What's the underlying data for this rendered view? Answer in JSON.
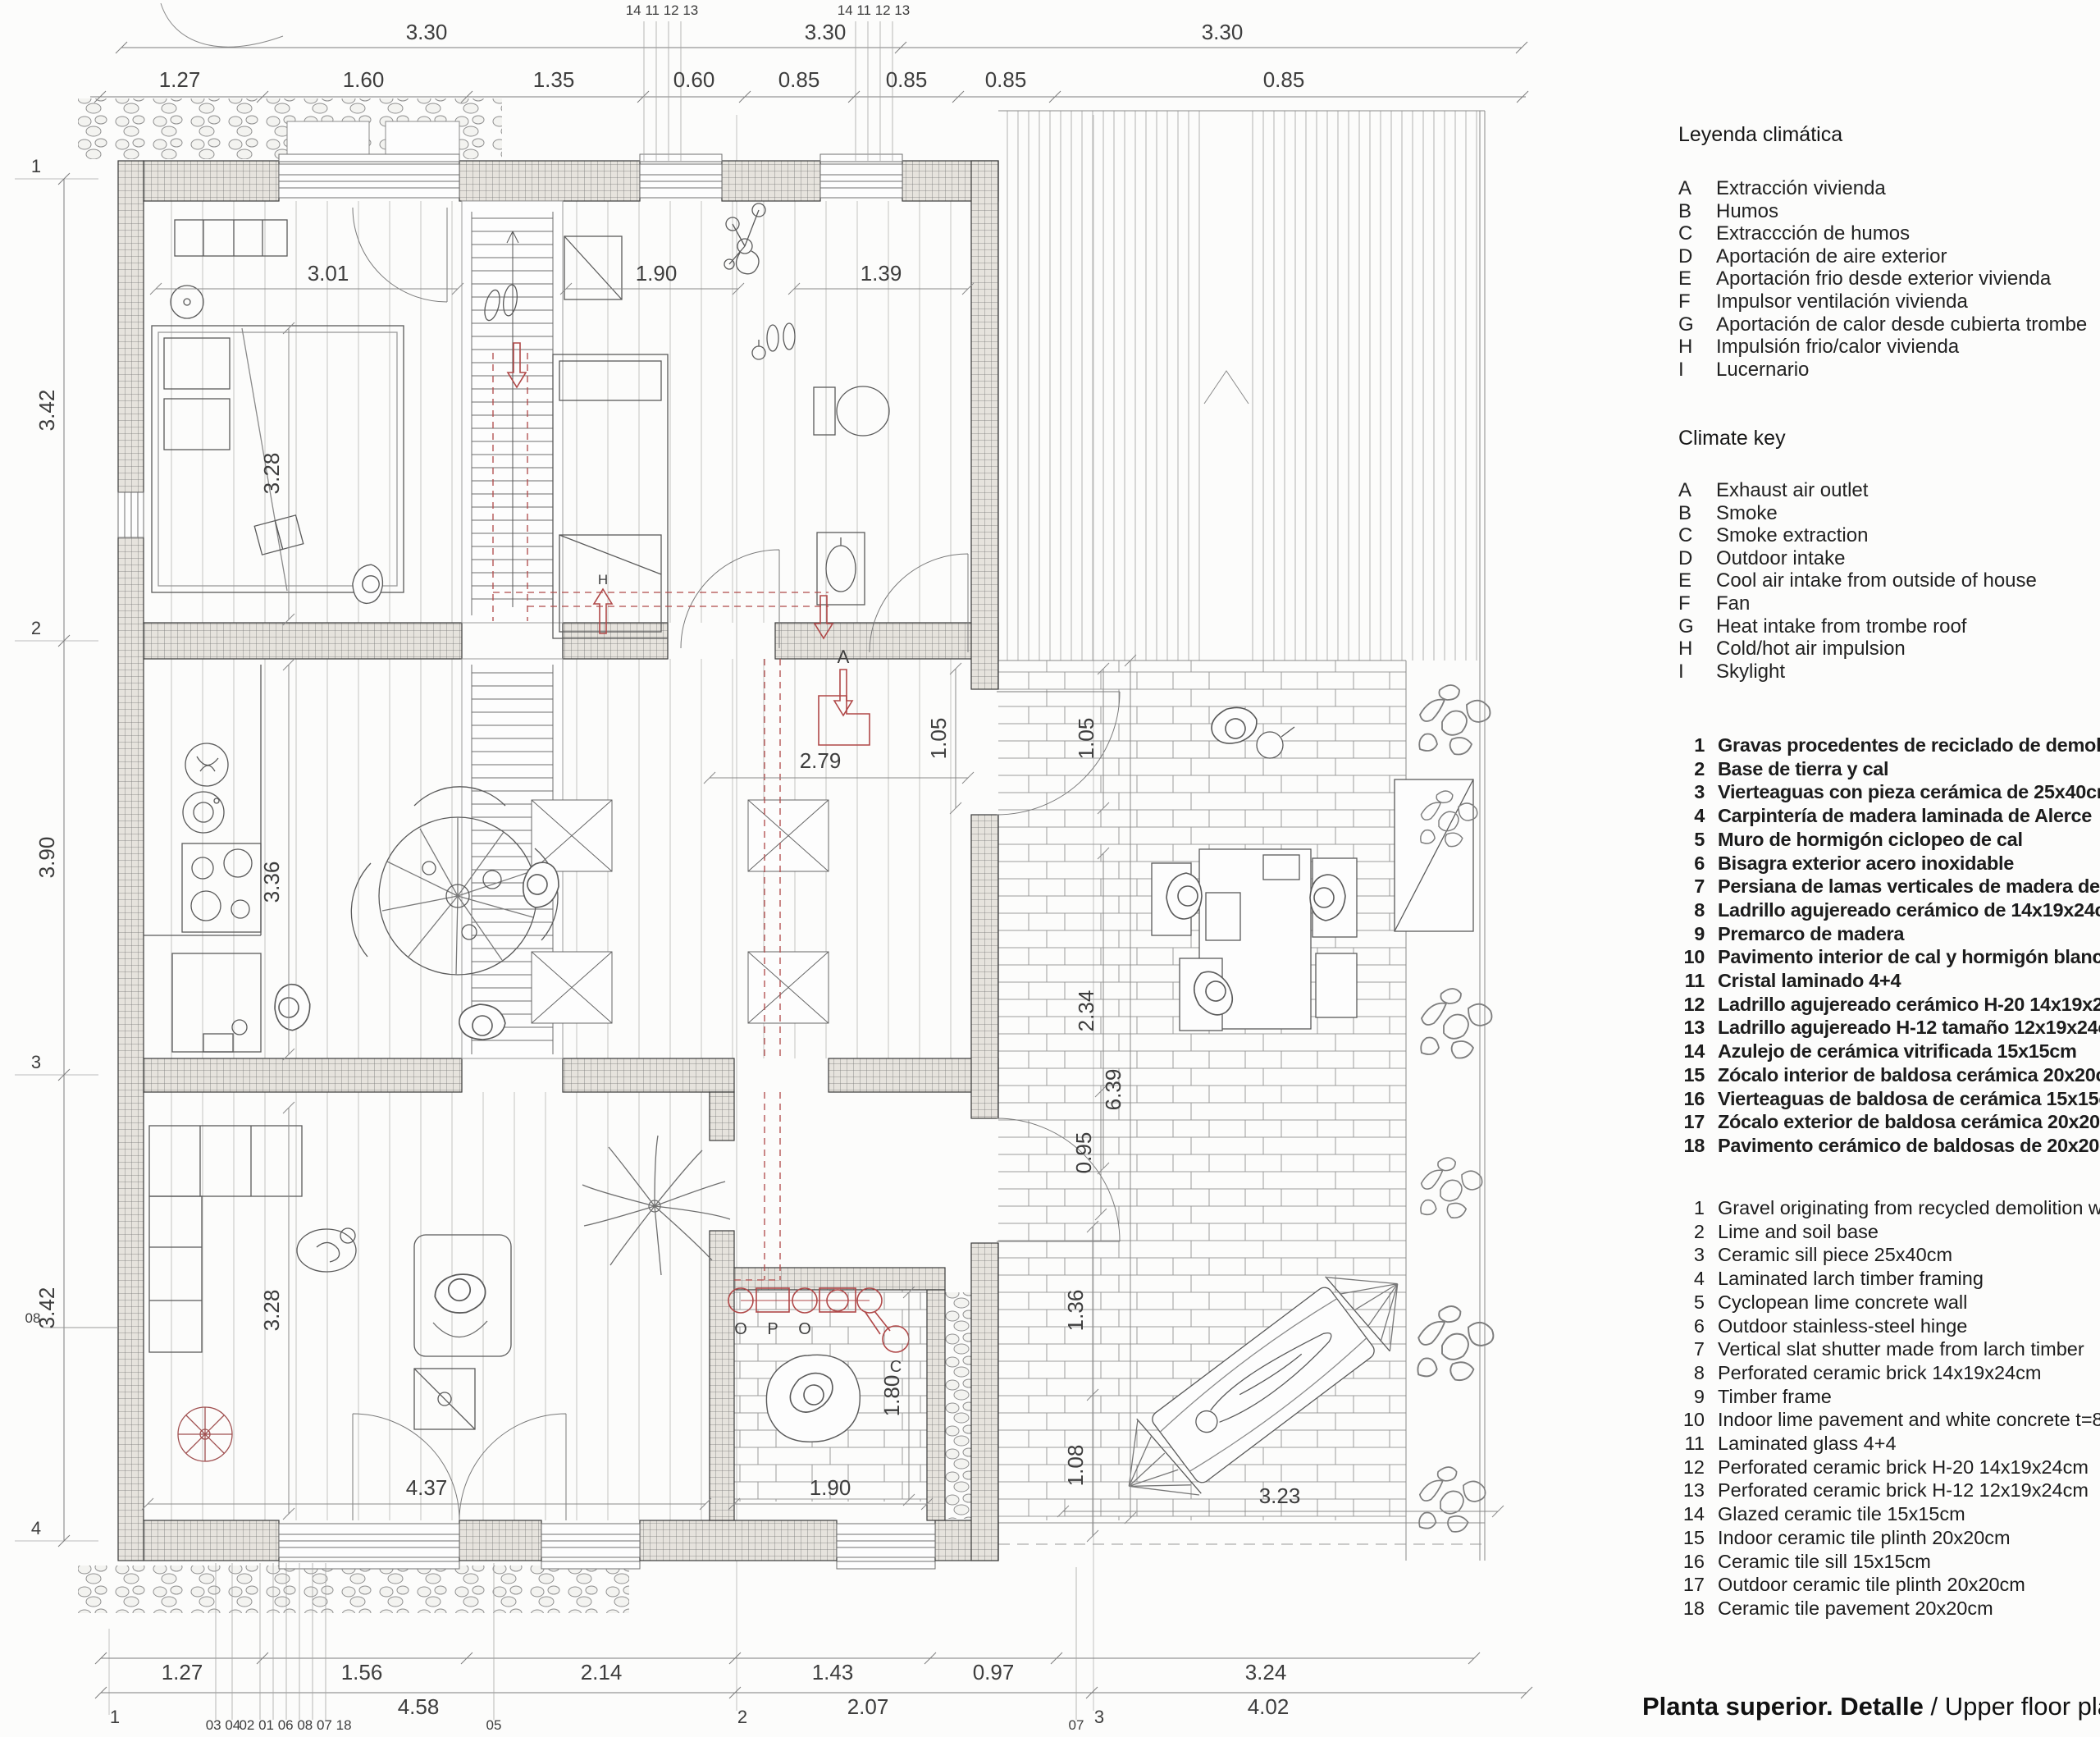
{
  "title": {
    "es": "Planta superior. Detalle",
    "sep": " / ",
    "en": "Upper floor plan. Det"
  },
  "legend_es": {
    "title": "Leyenda climática",
    "items": [
      [
        "A",
        "Extracción vivienda"
      ],
      [
        "B",
        "Humos"
      ],
      [
        "C",
        "Extraccción de humos"
      ],
      [
        "D",
        "Aportación de aire exterior"
      ],
      [
        "E",
        "Aportación frio desde exterior vivienda"
      ],
      [
        "F",
        "Impulsor ventilación vivienda"
      ],
      [
        "G",
        "Aportación de calor desde cubierta trombe"
      ],
      [
        "H",
        "Impulsión frio/calor vivienda"
      ],
      [
        "I",
        "Lucernario"
      ]
    ]
  },
  "legend_en": {
    "title": "Climate key",
    "items": [
      [
        "A",
        "Exhaust air outlet"
      ],
      [
        "B",
        "Smoke"
      ],
      [
        "C",
        "Smoke extraction"
      ],
      [
        "D",
        "Outdoor intake"
      ],
      [
        "E",
        "Cool air intake from outside of house"
      ],
      [
        "F",
        "Fan"
      ],
      [
        "G",
        "Heat intake from trombe roof"
      ],
      [
        "H",
        "Cold/hot air impulsion"
      ],
      [
        "I",
        "Skylight"
      ]
    ]
  },
  "notes_es": {
    "items": [
      [
        "1",
        "Gravas procedentes de reciclado de demolición"
      ],
      [
        "2",
        "Base de tierra y cal"
      ],
      [
        "3",
        "Vierteaguas con pieza cerámica de 25x40cm"
      ],
      [
        "4",
        "Carpintería de madera laminada de Alerce"
      ],
      [
        "5",
        "Muro de hormigón ciclopeo de cal"
      ],
      [
        "6",
        "Bisagra exterior acero inoxidable"
      ],
      [
        "7",
        "Persiana de lamas verticales de madera de alerce"
      ],
      [
        "8",
        "Ladrillo agujereado cerámico de 14x19x24cm"
      ],
      [
        "9",
        "Premarco de madera"
      ],
      [
        "10",
        "Pavimento interior de cal y hormigón blanco e:80m"
      ],
      [
        "11",
        "Cristal laminado 4+4"
      ],
      [
        "12",
        "Ladrillo agujereado cerámico H-20 14x19x24cm"
      ],
      [
        "13",
        "Ladrillo agujereado H-12 tamaño 12x19x24cm"
      ],
      [
        "14",
        "Azulejo de cerámica vitrificada 15x15cm"
      ],
      [
        "15",
        "Zócalo interior de baldosa cerámica 20x20cm"
      ],
      [
        "16",
        "Vierteaguas de baldosa de cerámica 15x15cm"
      ],
      [
        "17",
        "Zócalo exterior de baldosa cerámica 20x20cm"
      ],
      [
        "18",
        "Pavimento cerámico de baldosas de 20x20cm"
      ]
    ]
  },
  "notes_en": {
    "items": [
      [
        "1",
        "Gravel originating from recycled demolition waste"
      ],
      [
        "2",
        "Lime and soil base"
      ],
      [
        "3",
        "Ceramic sill piece 25x40cm"
      ],
      [
        "4",
        "Laminated larch timber framing"
      ],
      [
        "5",
        "Cyclopean lime concrete wall"
      ],
      [
        "6",
        "Outdoor stainless-steel hinge"
      ],
      [
        "7",
        "Vertical slat shutter made from larch timber"
      ],
      [
        "8",
        "Perforated ceramic brick 14x19x24cm"
      ],
      [
        "9",
        "Timber frame"
      ],
      [
        "10",
        "Indoor lime pavement and white concrete t=80mm"
      ],
      [
        "11",
        "Laminated glass 4+4"
      ],
      [
        "12",
        "Perforated ceramic brick H-20 14x19x24cm"
      ],
      [
        "13",
        "Perforated ceramic brick H-12 12x19x24cm"
      ],
      [
        "14",
        "Glazed ceramic tile 15x15cm"
      ],
      [
        "15",
        "Indoor ceramic tile plinth 20x20cm"
      ],
      [
        "16",
        "Ceramic tile sill 15x15cm"
      ],
      [
        "17",
        "Outdoor ceramic tile plinth 20x20cm"
      ],
      [
        "18",
        "Ceramic tile pavement 20x20cm"
      ]
    ]
  },
  "dims": {
    "top_overall": [
      "3.30",
      "3.30",
      "3.30"
    ],
    "top_detail": [
      "1.27",
      "1.60",
      "1.35",
      "0.60",
      "0.85",
      "0.85",
      "0.85",
      "0.85"
    ],
    "left": [
      "3.42",
      "3.90",
      "3.42"
    ],
    "bottom_detail": [
      "1.27",
      "1.56",
      "2.14",
      "1.43",
      "0.97",
      "3.24"
    ],
    "bottom_overall": [
      "4.58",
      "2.07",
      "4.02"
    ],
    "interior": {
      "bedroom_w": "3.01",
      "bed_len": "3.28",
      "bedroom2_w": "1.90",
      "bath_w": "1.39",
      "kitchen_len": "3.36",
      "hall_w": "2.79",
      "door_a": "1.05",
      "door_b": "1.05",
      "patio": "2.34",
      "courtyard": "6.39",
      "step": "0.95",
      "living_len": "3.28",
      "living_w": "4.37",
      "mech_w": "1.90",
      "mech_len": "1.80",
      "hammock_a": "1.36",
      "hammock_b": "1.08",
      "terrace": "3.23"
    }
  },
  "grid": {
    "left": [
      "1",
      "2",
      "3",
      "4"
    ],
    "bottom": [
      "1",
      "2",
      "3"
    ]
  },
  "callouts": {
    "top": [
      "14 11 12 13",
      "14 11 12 13"
    ],
    "bottom": [
      "03 04",
      "02 01 06 08 07 18",
      "05",
      "07"
    ],
    "left": "08"
  },
  "hvac": {
    "hall_arrow": "A",
    "bed_arrow": "H",
    "units": [
      "O",
      "P",
      "O"
    ],
    "chimney": "C"
  }
}
